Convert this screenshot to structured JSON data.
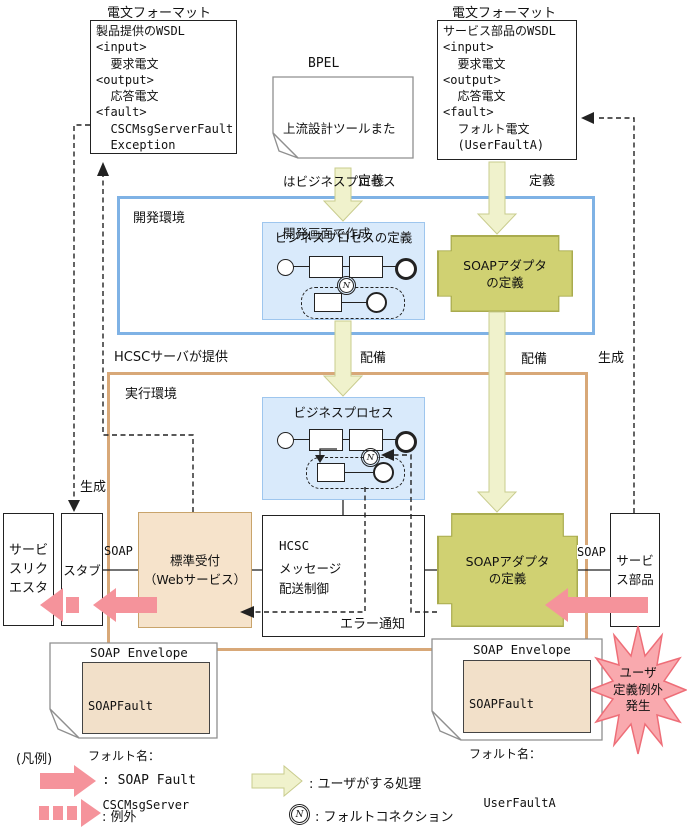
{
  "colors": {
    "dev_env_border": "#7FB2E5",
    "run_env_border": "#D8A878",
    "process_box_fill": "#D9EAFB",
    "adapter_fill": "#D0D172",
    "reception_fill": "#F6E3CB",
    "envelope_inner_fill": "#F2E0C9",
    "soap_fault_pink": "#F5939B",
    "user_action_yellow": "#F0F2CC"
  },
  "top": {
    "left_format_label": "電文フォーマット",
    "right_format_label": "電文フォーマット",
    "wsdl_left_lines": [
      "製品提供のWSDL",
      "<input>",
      "  要求電文",
      "<output>",
      "  応答電文",
      "<fault>",
      "  CSCMsgServerFault",
      "  Exception"
    ],
    "wsdl_right_lines": [
      "サービス部品のWSDL",
      "<input>",
      "  要求電文",
      "<output>",
      "  応答電文",
      "<fault>",
      "  フォルト電文",
      "  (UserFaultA)"
    ],
    "bpel_label": "BPEL",
    "bpel_note_lines": [
      "上流設計ツールまた",
      "はビジネスプロセス",
      "開発画面で作成"
    ]
  },
  "labels": {
    "define_left": "定義",
    "define_right": "定義",
    "deploy_left": "配備",
    "deploy_right": "配備",
    "generate_left": "生成",
    "generate_right": "生成",
    "hcsc_provided": "HCSCサーバが提供",
    "soap_left": "SOAP",
    "soap_right": "SOAP",
    "error_notification": "エラー通知"
  },
  "dev_env": {
    "title": "開発環境",
    "bp_def_title": "ビジネスプロセスの定義",
    "adapter_line1": "SOAPアダプタ",
    "adapter_line2": "の定義"
  },
  "run_env": {
    "title": "実行環境",
    "bp_title": "ビジネスプロセス",
    "hcsc_lines": [
      "HCSC",
      "メッセージ",
      "配送制御"
    ],
    "reception_line1": "標準受付",
    "reception_line2": "（Webサービス）",
    "adapter_line1": "SOAPアダプタ",
    "adapter_line2": "の定義"
  },
  "side": {
    "requester_lines": [
      "サービ",
      "スリク",
      "エスタ"
    ],
    "stub": "スタブ",
    "service_part_lines": [
      "サービ",
      "ス部品"
    ]
  },
  "envelopes": {
    "left_title": "SOAP Envelope",
    "left_lines": [
      "SOAPFault",
      "フォルト名：",
      "  CSCMsgServer",
      "  FaultException"
    ],
    "right_title": "SOAP Envelope",
    "right_lines": [
      "SOAPFault",
      "フォルト名：",
      "  UserFaultA"
    ]
  },
  "starburst": {
    "lines": [
      "ユーザ",
      "定義例外",
      "発生"
    ]
  },
  "icons": {
    "fault_connection_letter": "N"
  },
  "legend": {
    "title": "(凡例)",
    "soap_fault": ": SOAP Fault",
    "exception": ": 例外",
    "user_action": ": ユーザがする処理",
    "fault_connection": ": フォルトコネクション"
  }
}
